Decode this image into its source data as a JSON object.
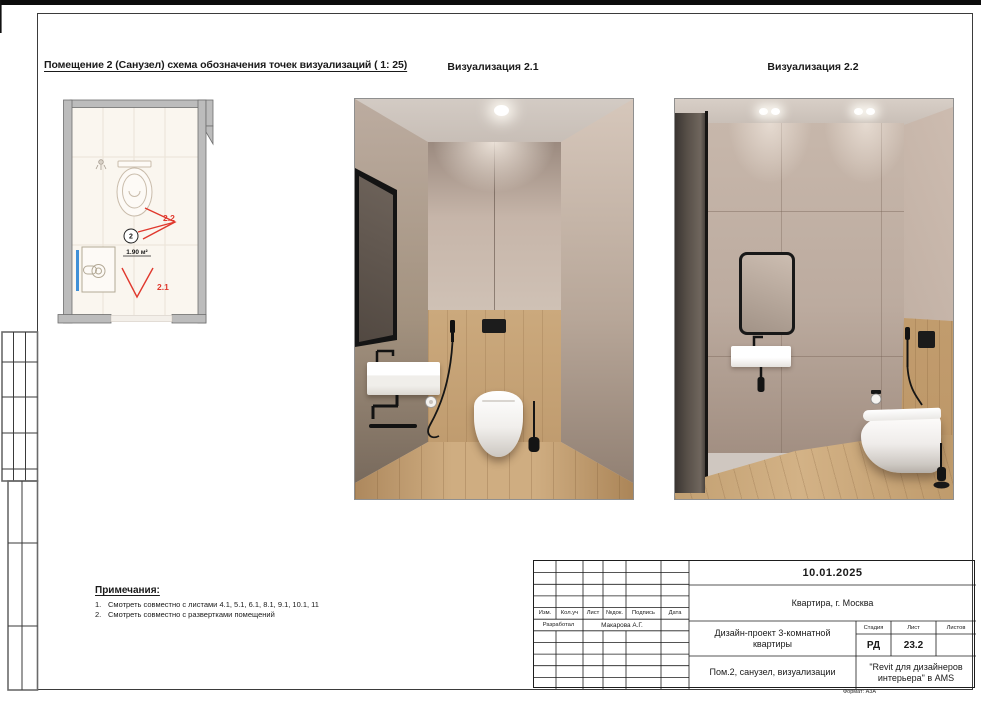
{
  "sheet": {
    "title": "Помещение 2 (Санузел) схема обозначения точек визуализаций ( 1: 25)",
    "format_note": "Формат: А3А"
  },
  "plan": {
    "room_number": "2",
    "room_area": "1.90 м²",
    "camera_1_label": "2.1",
    "camera_2_label": "2.2",
    "colors": {
      "marker_red": "#e0382d",
      "accent_blue": "#3f8fd6",
      "wall_gray": "#bcbcbc",
      "floor_cream": "#faf6ef"
    }
  },
  "visualizations": [
    {
      "label": "Визуализация 2.1"
    },
    {
      "label": "Визуализация 2.2"
    }
  ],
  "notes": {
    "heading": "Примечания:",
    "items": [
      {
        "num": "1.",
        "text": "Смотреть совместно с листами 4.1, 5.1, 6.1, 8.1, 9.1, 10.1, 11"
      },
      {
        "num": "2.",
        "text": "Смотреть совместно с развертками помещений"
      }
    ]
  },
  "titleblock": {
    "date": "10.01.2025",
    "object": "Квартира, г. Москва",
    "project": "Дизайн-проект 3-комнатной квартиры",
    "sheet_name": "Пом.2, санузел, визуализации",
    "organization": "\"Revit для дизайнеров интерьера\" в AMS",
    "developed_label": "Разработал",
    "developed_by": "Макарова А.Г.",
    "stage_value": "РД",
    "sheet_number": "23.2",
    "sheets_total": "",
    "headers": {
      "izm": "Изм.",
      "koluch": "Кол.уч",
      "list": "Лист",
      "ndok": "№док.",
      "podpis": "Подпись",
      "data": "Дата",
      "stadiya": "Стадия",
      "list2": "Лист",
      "listov": "Листов"
    }
  }
}
